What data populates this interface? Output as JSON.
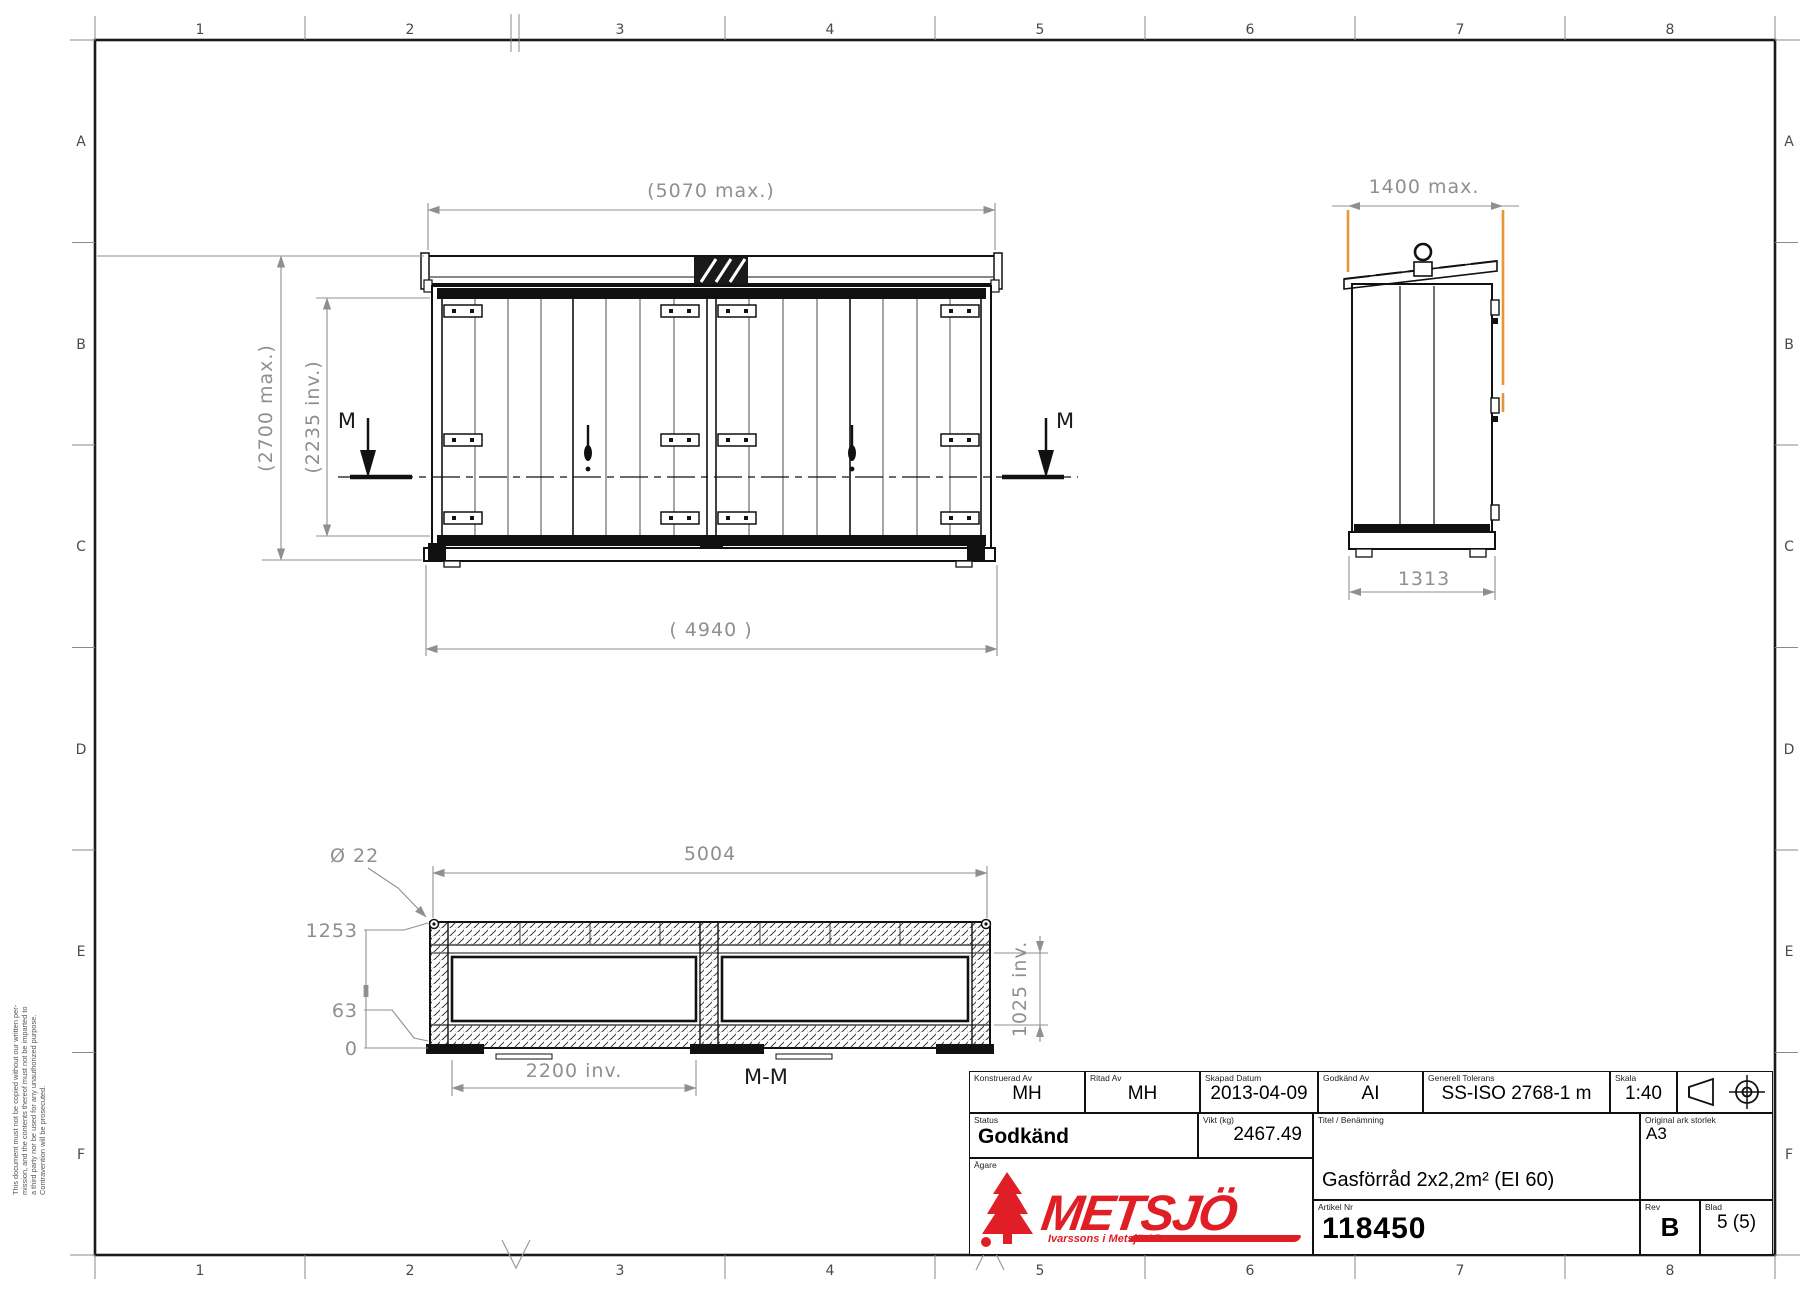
{
  "sheet": {
    "grid_cols": [
      "1",
      "2",
      "3",
      "4",
      "5",
      "6",
      "7",
      "8"
    ],
    "grid_rows": [
      "A",
      "B",
      "C",
      "D",
      "E",
      "F"
    ],
    "copyright": {
      "line1": "This document must not be copied without our written per-",
      "line2": "mission, and the contents thereof must not be imparted to",
      "line3": "a third party nor be used for any unauthorized purpose.",
      "line4": "Contravention will be prosecuted."
    }
  },
  "views": {
    "front": {
      "dim_width_max": "(5070 max.)",
      "dim_height_max": "(2700 max.)",
      "dim_height_inner": "(2235 inv.)",
      "dim_width_frame": "( 4940 )",
      "section_marker_left": "M",
      "section_marker_right": "M"
    },
    "side": {
      "dim_width_max": "1400 max.",
      "dim_base": "1313"
    },
    "section": {
      "label": "M-M",
      "dim_hole": "Ø 22",
      "dim_width": "5004",
      "ord_top": "1253",
      "ord_mid": "63",
      "ord_zero": "0",
      "dim_inner_width": "2200 inv.",
      "dim_inner_depth": "1025 inv."
    }
  },
  "title_block": {
    "designed": {
      "label": "Konstruerad Av",
      "value": "MH"
    },
    "drawn": {
      "label": "Ritad Av",
      "value": "MH"
    },
    "created": {
      "label": "Skapad Datum",
      "value": "2013-04-09"
    },
    "approved": {
      "label": "Godkänd Av",
      "value": "AI"
    },
    "tolerance": {
      "label": "Generell Tolerans",
      "value": "SS-ISO 2768-1 m"
    },
    "scale": {
      "label": "Skala",
      "value": "1:40"
    },
    "status": {
      "label": "Status",
      "value": "Godkänd"
    },
    "weight": {
      "label": "Vikt (kg)",
      "value": "2467.49"
    },
    "title": {
      "label": "Titel / Benämning",
      "value": "Gasförråd 2x2,2m² (EI 60)"
    },
    "sheet_size": {
      "label": "Original ark storlek",
      "value": "A3"
    },
    "owner": {
      "label": "Ägare"
    },
    "article": {
      "label": "Artikel Nr",
      "value": "118450"
    },
    "rev": {
      "label": "Rev",
      "value": "B"
    },
    "page": {
      "label": "Blad",
      "value": "5 (5)"
    },
    "logo": {
      "name": "METSJÖ",
      "tagline": "Ivarssons i Metsjö AB"
    }
  },
  "colors": {
    "highlight_orange": "#E8953C",
    "logo_red": "#E01E25",
    "dim_gray": "#8f8f8f"
  }
}
